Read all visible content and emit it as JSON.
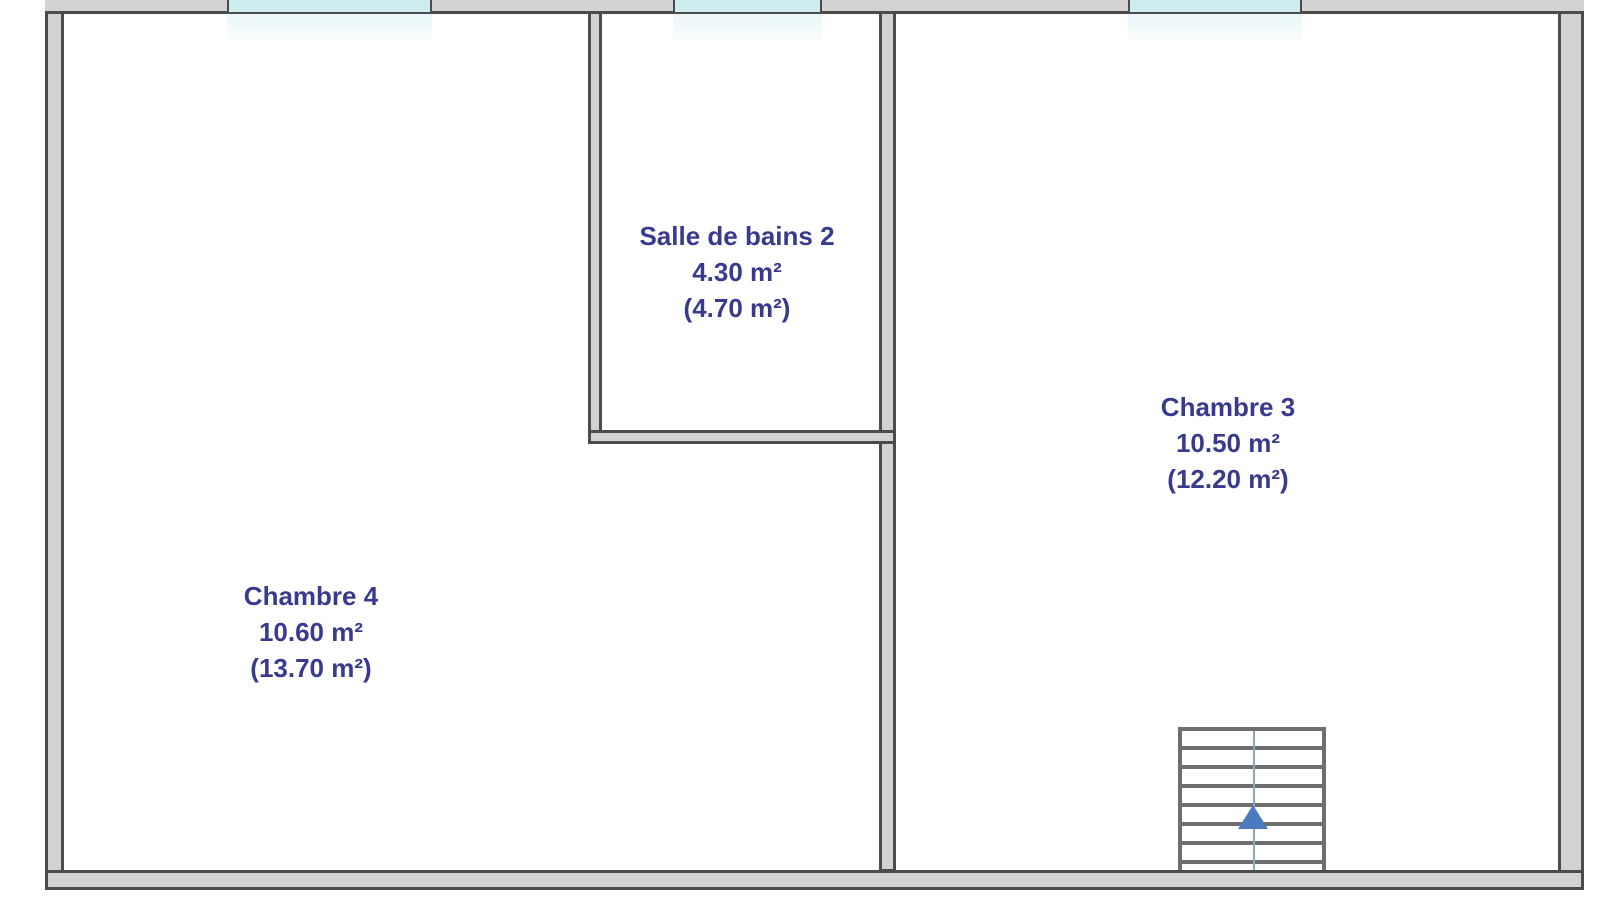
{
  "rooms": [
    {
      "name": "Salle de bains 2",
      "area_net": "4.30 m²",
      "area_gross": "(4.70 m²)"
    },
    {
      "name": "Chambre 3",
      "area_net": "10.50 m²",
      "area_gross": "(12.20 m²)"
    },
    {
      "name": "Chambre 4",
      "area_net": "10.60 m²",
      "area_gross": "(13.70 m²)"
    }
  ],
  "features": {
    "windows": [
      "window-1",
      "window-2",
      "window-3"
    ],
    "staircase": {
      "arrow_direction": "up"
    }
  },
  "colors": {
    "background": "#ffffff",
    "wall_fill": "#d3d3d3",
    "wall_outline": "#4c4c4c",
    "window_fill": "#ccecee",
    "room_label_text": "#383a8e",
    "stair_lines": "#6e6e6e",
    "stair_guide_line": "#8ca6c0",
    "stair_arrow": "#4a7abf"
  }
}
